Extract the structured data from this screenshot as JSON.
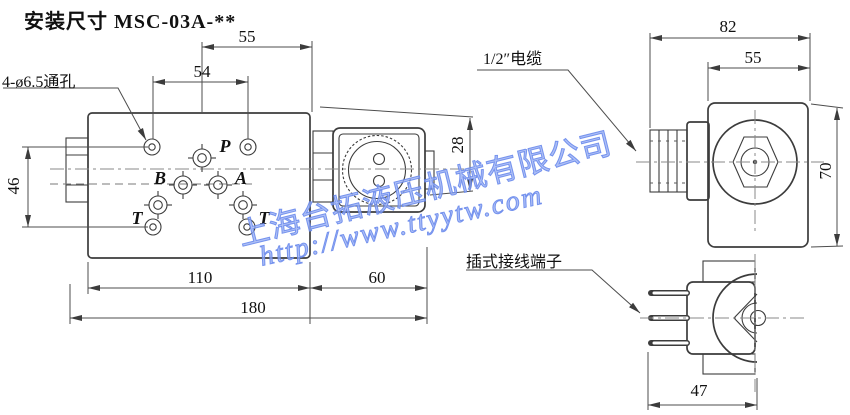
{
  "title": "安装尺寸 MSC-03A-**",
  "watermark": {
    "company": "上海台拓液压机械有限公司",
    "url": "http://www.ttyytw.com",
    "color": "#7d9cf5"
  },
  "front_view": {
    "hole_callout": "4-ø6.5通孔",
    "ports": {
      "p": "P",
      "b": "B",
      "a": "A",
      "t1": "T",
      "t2": "T"
    },
    "dims": {
      "d55": "55",
      "d54": "54",
      "d46": "46",
      "d28": "28",
      "d110": "110",
      "d60": "60",
      "d180": "180"
    }
  },
  "side_view": {
    "cable_callout": "1/2″电缆",
    "dims": {
      "d82": "82",
      "d55": "55",
      "d70": "70"
    }
  },
  "end_view": {
    "terminal_callout": "插式接线端子",
    "dims": {
      "d47": "47"
    }
  }
}
